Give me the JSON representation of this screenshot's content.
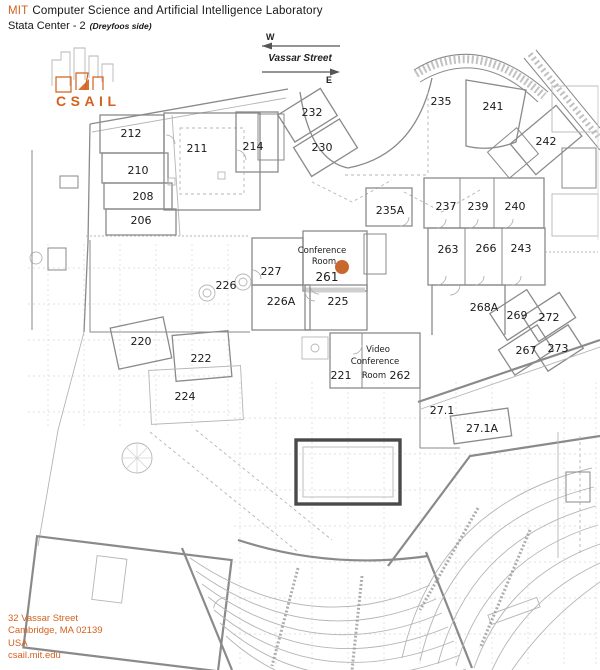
{
  "header": {
    "org_prefix": "MIT",
    "org_rest": "Computer Science and Artificial Intelligence Laboratory",
    "building": "Stata Center - 2",
    "side_note": "(Dreyfoos side)"
  },
  "compass": {
    "west": "W",
    "east": "E",
    "street": "Vassar Street"
  },
  "logo": {
    "wordmark": "CSAIL"
  },
  "rooms": {
    "r206": "206",
    "r208": "208",
    "r210": "210",
    "r211": "211",
    "r212": "212",
    "r214": "214",
    "r220": "220",
    "r221": "221",
    "r222": "222",
    "r224": "224",
    "r225": "225",
    "r226": "226",
    "r226A": "226A",
    "r227": "227",
    "r230": "230",
    "r232": "232",
    "r235": "235",
    "r235A": "235A",
    "r237": "237",
    "r239": "239",
    "r240": "240",
    "r241": "241",
    "r242": "242",
    "r243": "243",
    "r261": "261",
    "r262": "262",
    "r263": "263",
    "r266": "266",
    "r267": "267",
    "r268A": "268A",
    "r269": "269",
    "r271": "27.1",
    "r271A": "27.1A",
    "r272": "272",
    "r273": "273"
  },
  "labels": {
    "conference_room": [
      "Conference",
      "Room"
    ],
    "video_conference_room": [
      "Video",
      "Conference",
      "Room"
    ]
  },
  "marker": {
    "room": "261",
    "color": "#C8682E"
  },
  "footer": {
    "address_line1": "32 Vassar Street",
    "address_line2": "Cambridge, MA 02139",
    "address_line3": "USA",
    "website": "csail.mit.edu"
  },
  "colors": {
    "accent": "#D4611E",
    "wall_gray": "#8a8a8a"
  }
}
